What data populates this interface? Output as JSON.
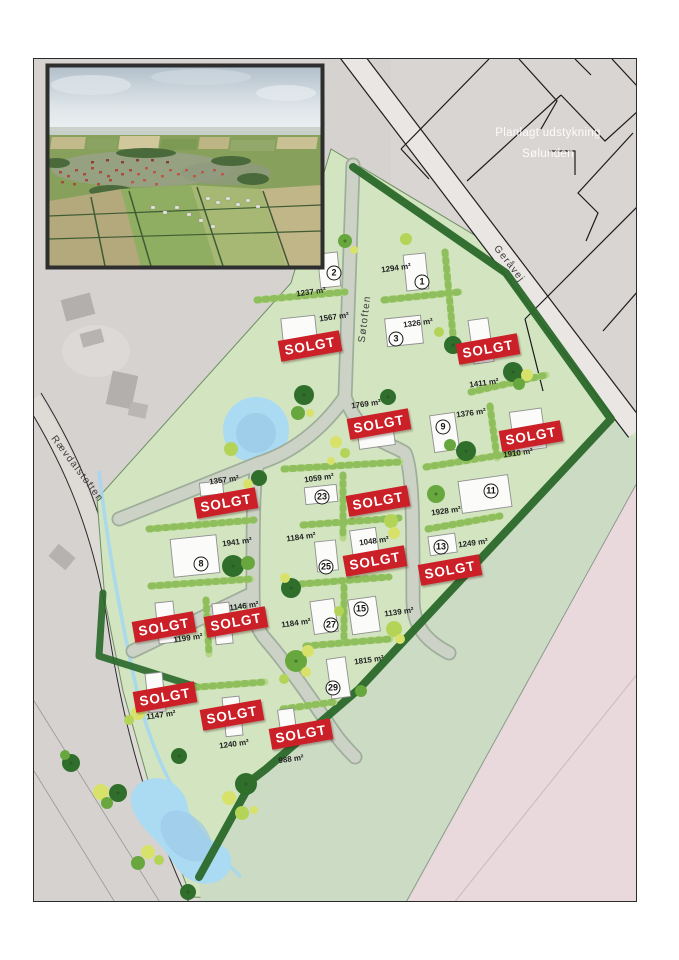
{
  "map": {
    "title": {
      "line1": "Planlagt udstykning",
      "line2": "Sølunden"
    },
    "sold_label": "SOLGT",
    "colors": {
      "sold_red": "#cb2027",
      "site_green": "#d2e4c0",
      "hedge_dark": "#2d6a2c",
      "hedge_light": "#b6d78a",
      "water_blue": "#abdaf3",
      "pink_area": "#e9d9dc",
      "base_gray": "#d6d2cf"
    },
    "streets": [
      {
        "name": "Søtoften",
        "x": 364,
        "y": 318,
        "rotate": -83
      },
      {
        "name": "Geråvej",
        "x": 508,
        "y": 263,
        "rotate": 52
      },
      {
        "name": "Rævdalstoften",
        "x": 76,
        "y": 468,
        "rotate": 53
      }
    ],
    "lots": [
      {
        "number": "1",
        "area": "1294 m²",
        "number_pos": {
          "x": 421,
          "y": 281
        },
        "area_pos": {
          "x": 395,
          "y": 267
        }
      },
      {
        "number": "2",
        "area": "1237 m²",
        "number_pos": {
          "x": 333,
          "y": 272
        },
        "area_pos": {
          "x": 310,
          "y": 291
        }
      },
      {
        "number": "3",
        "area": "1326 m²",
        "number_pos": {
          "x": 395,
          "y": 338
        },
        "area_pos": {
          "x": 417,
          "y": 322
        }
      },
      {
        "number": "8",
        "area": "1941 m²",
        "number_pos": {
          "x": 200,
          "y": 563
        },
        "area_pos": {
          "x": 236,
          "y": 541
        }
      },
      {
        "number": "9",
        "area": "1376 m²",
        "number_pos": {
          "x": 442,
          "y": 426
        },
        "area_pos": {
          "x": 470,
          "y": 412
        }
      },
      {
        "number": "11",
        "area": "1928 m²",
        "number_pos": {
          "x": 490,
          "y": 490
        },
        "area_pos": {
          "x": 445,
          "y": 510
        }
      },
      {
        "number": "13",
        "area": "1249 m²",
        "number_pos": {
          "x": 440,
          "y": 546
        },
        "area_pos": {
          "x": 472,
          "y": 542
        }
      },
      {
        "number": "15",
        "area": "1139 m²",
        "number_pos": {
          "x": 360,
          "y": 608
        },
        "area_pos": {
          "x": 398,
          "y": 611
        }
      },
      {
        "number": "23",
        "area": "1059 m²",
        "number_pos": {
          "x": 321,
          "y": 496
        },
        "area_pos": {
          "x": 318,
          "y": 477
        }
      },
      {
        "number": "25",
        "area": "1184 m²",
        "number_pos": {
          "x": 325,
          "y": 566
        },
        "area_pos": {
          "x": 300,
          "y": 536
        }
      },
      {
        "number": "27",
        "area": "1184 m²",
        "number_pos": {
          "x": 330,
          "y": 624
        },
        "area_pos": {
          "x": 295,
          "y": 622
        }
      },
      {
        "number": "29",
        "area": "1815 m²",
        "number_pos": {
          "x": 332,
          "y": 687
        },
        "area_pos": {
          "x": 368,
          "y": 659
        }
      }
    ],
    "unnumbered_areas": [
      {
        "area": "1567 m²",
        "x": 333,
        "y": 316
      },
      {
        "area": "1411 m²",
        "x": 483,
        "y": 382
      },
      {
        "area": "1769 m²",
        "x": 365,
        "y": 403
      },
      {
        "area": "1910 m²",
        "x": 517,
        "y": 452
      },
      {
        "area": "1357 m²",
        "x": 223,
        "y": 479
      },
      {
        "area": "1048 m²",
        "x": 373,
        "y": 540
      },
      {
        "area": "1146 m²",
        "x": 243,
        "y": 605
      },
      {
        "area": "1199 m²",
        "x": 187,
        "y": 637
      },
      {
        "area": "1147 m²",
        "x": 160,
        "y": 714
      },
      {
        "area": "1240 m²",
        "x": 233,
        "y": 743
      },
      {
        "area": "988 m²",
        "x": 290,
        "y": 758
      }
    ],
    "sold_banners": [
      {
        "x": 309,
        "y": 345,
        "rotate": -10
      },
      {
        "x": 487,
        "y": 348,
        "rotate": -10
      },
      {
        "x": 378,
        "y": 423,
        "rotate": -10
      },
      {
        "x": 530,
        "y": 435,
        "rotate": -10
      },
      {
        "x": 225,
        "y": 502,
        "rotate": -10
      },
      {
        "x": 377,
        "y": 500,
        "rotate": -10
      },
      {
        "x": 374,
        "y": 560,
        "rotate": -10
      },
      {
        "x": 449,
        "y": 569,
        "rotate": -10
      },
      {
        "x": 163,
        "y": 626,
        "rotate": -10
      },
      {
        "x": 235,
        "y": 621,
        "rotate": -10
      },
      {
        "x": 164,
        "y": 696,
        "rotate": -10
      },
      {
        "x": 231,
        "y": 714,
        "rotate": -10
      },
      {
        "x": 300,
        "y": 733,
        "rotate": -10
      }
    ]
  }
}
